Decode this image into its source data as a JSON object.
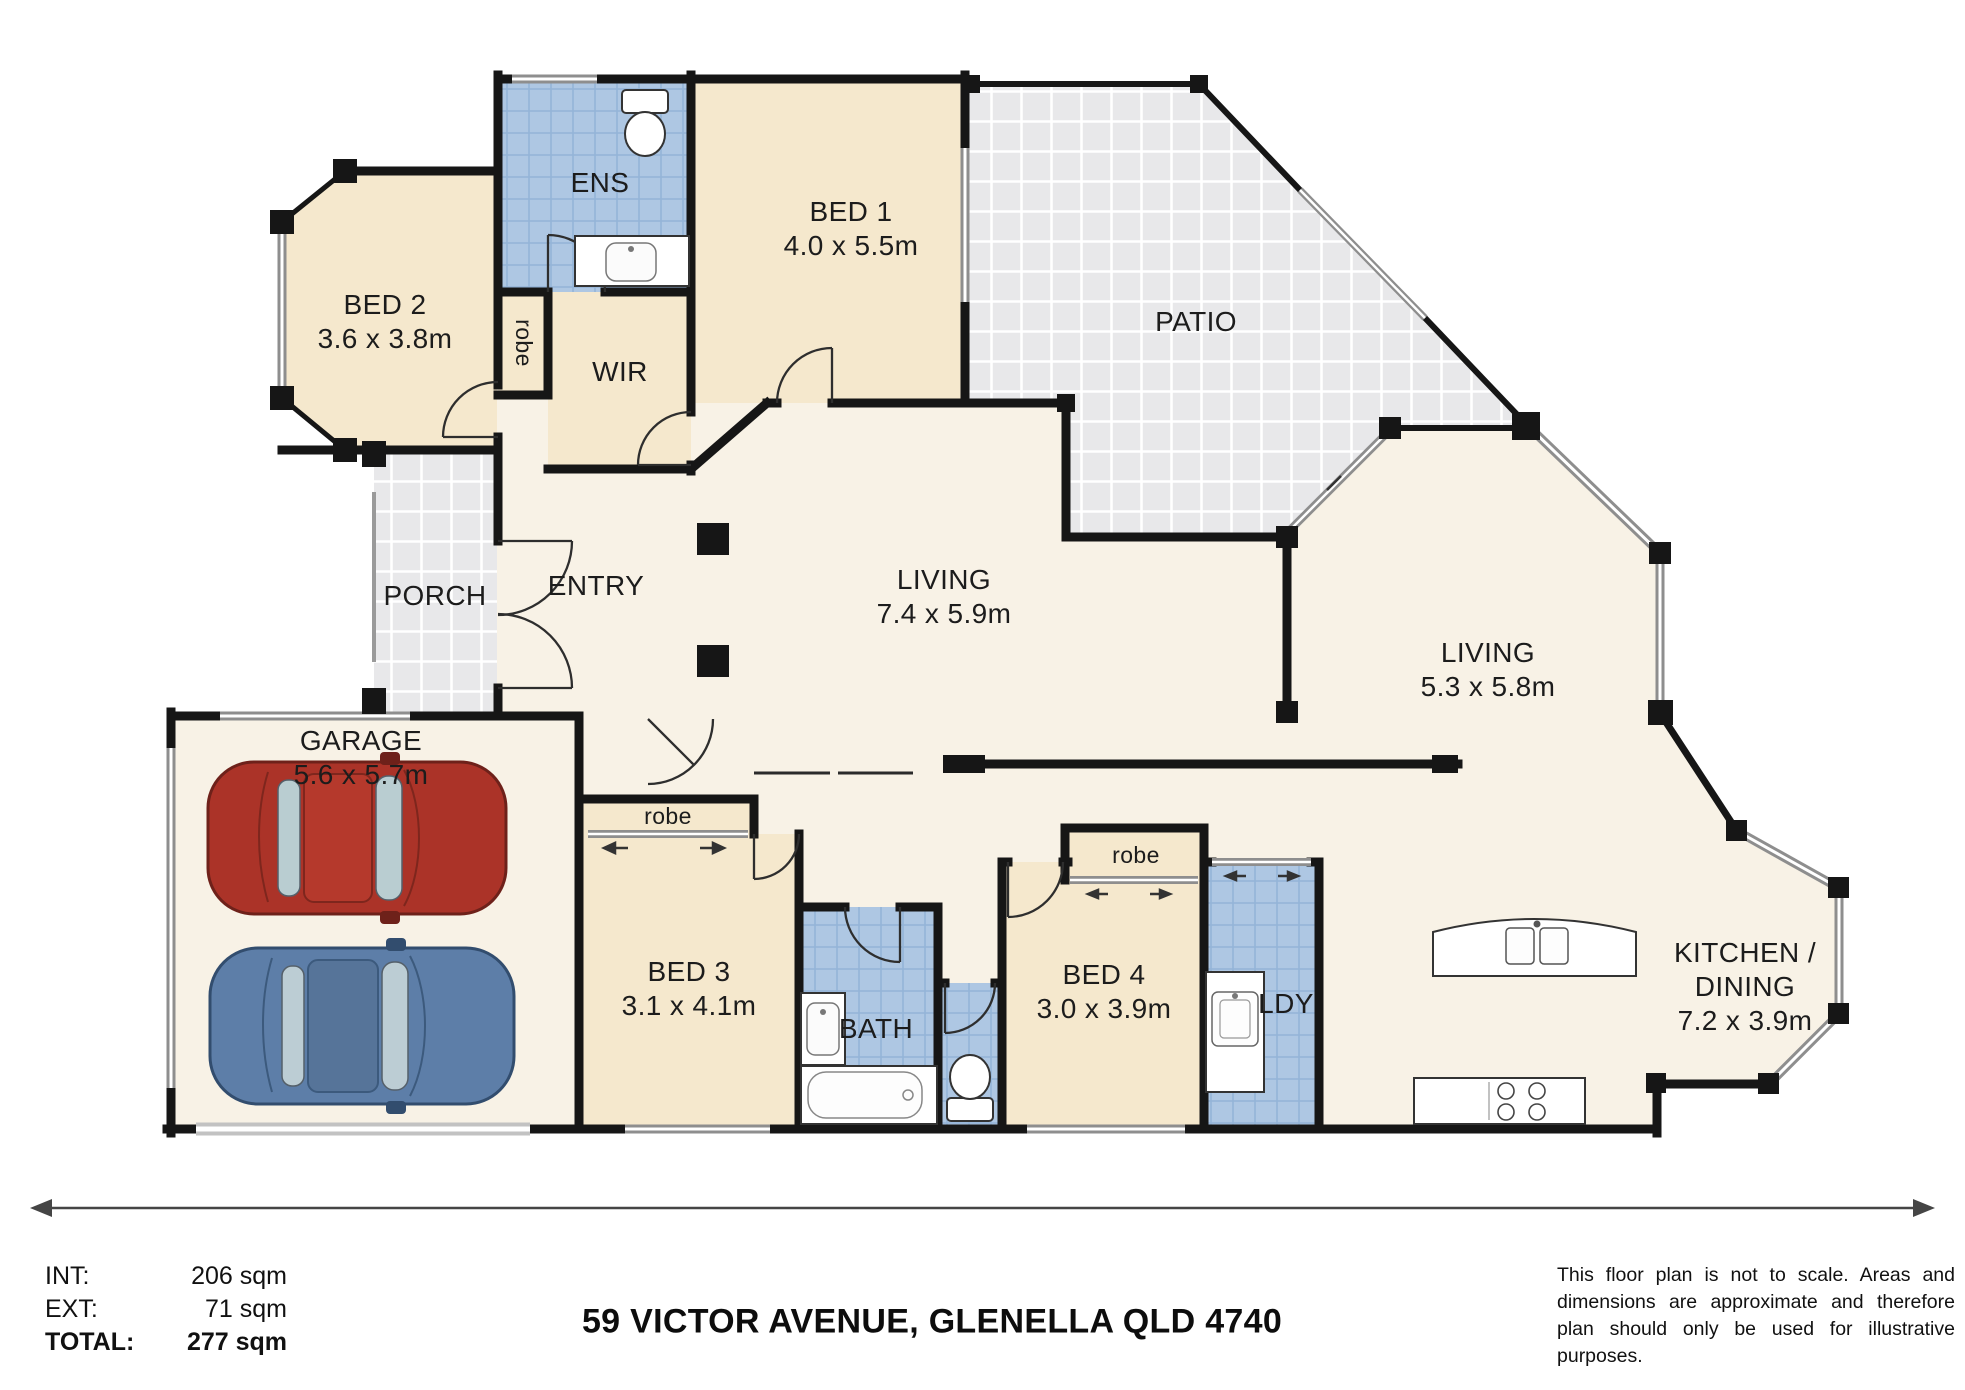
{
  "rooms": {
    "ens": {
      "name": "ENS"
    },
    "bed1": {
      "name": "BED 1",
      "dims": "4.0 x 5.5m"
    },
    "bed2": {
      "name": "BED 2",
      "dims": "3.6 x 3.8m"
    },
    "robe_bed2": {
      "name": "robe"
    },
    "wir": {
      "name": "WIR"
    },
    "patio": {
      "name": "PATIO"
    },
    "porch": {
      "name": "PORCH"
    },
    "entry": {
      "name": "ENTRY"
    },
    "living_main": {
      "name": "LIVING",
      "dims": "7.4 x 5.9m"
    },
    "living_rear": {
      "name": "LIVING",
      "dims": "5.3 x 5.8m"
    },
    "garage": {
      "name": "GARAGE",
      "dims": "5.6 x 5.7m"
    },
    "robe_bed3": {
      "name": "robe"
    },
    "bed3": {
      "name": "BED 3",
      "dims": "3.1 x 4.1m"
    },
    "bath": {
      "name": "BATH"
    },
    "bed4": {
      "name": "BED 4",
      "dims": "3.0 x 3.9m"
    },
    "robe_bed4": {
      "name": "robe"
    },
    "ldy": {
      "name": "LDY"
    },
    "kitchen": {
      "line1": "KITCHEN /",
      "line2": "DINING",
      "dims": "7.2 x 3.9m"
    }
  },
  "footer": {
    "stats": [
      {
        "label": "INT:",
        "value": "206 sqm"
      },
      {
        "label": "EXT:",
        "value": "71 sqm"
      },
      {
        "label": "TOTAL:",
        "value": "277 sqm"
      }
    ],
    "address": "59 VICTOR AVENUE, GLENELLA QLD 4740",
    "disclaimer": "This floor plan is not to scale. Areas and dimensions are approximate and therefore plan should only be used for illustrative purposes."
  },
  "colors": {
    "wall": "#161616",
    "room_cream": "#f5e8cd",
    "floor_offwhite": "#f8f2e6",
    "wet_blue": "#aec7e3",
    "tile_gray": "#e9e9ec",
    "window_gray": "#8e8e8e",
    "car_red": "#ab3328",
    "car_blue": "#5d7ea8"
  }
}
